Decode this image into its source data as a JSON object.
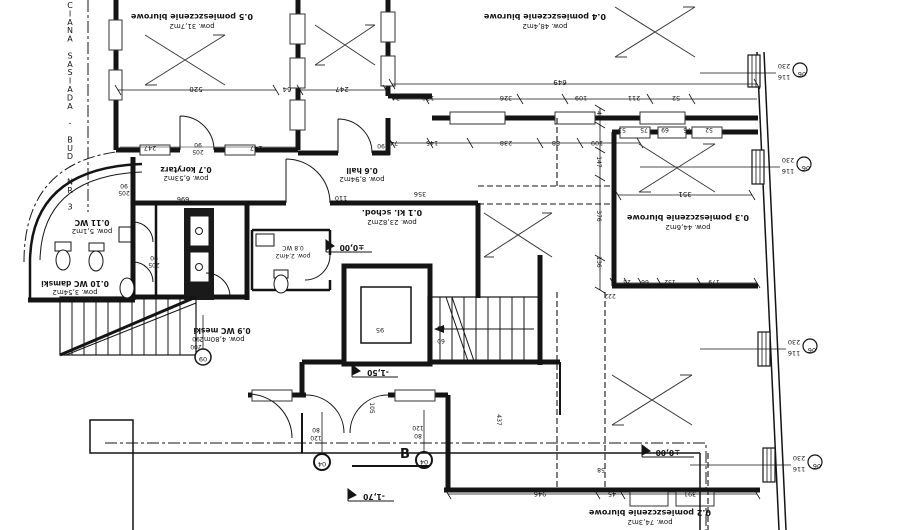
{
  "drawing": {
    "type": "architectural-floor-plan",
    "neighbor_wall_note": "CIANA SASIADA - BUD. NR 3",
    "section_label": "B",
    "line_color": "#141414",
    "background": "#ffffff"
  },
  "rooms": [
    {
      "id": "0.1",
      "name": "kl. schod.",
      "area": "pow. 23,82m2"
    },
    {
      "id": "0.2",
      "name": "pomieszczenie biurowe",
      "area": "pow. 74,3m2"
    },
    {
      "id": "0.3",
      "name": "pomieszczenie biurowe",
      "area": "pow. 44,6m2"
    },
    {
      "id": "0.4",
      "name": "pomieszczenie biurowe",
      "area": "pow. 48,4m2"
    },
    {
      "id": "0.5",
      "name": "pomieszczenie biurowe",
      "area": "pow. 31,7m2"
    },
    {
      "id": "0.6",
      "name": "hall",
      "area": "pow. 8,94m2"
    },
    {
      "id": "0.7",
      "name": "korytarz",
      "area": "pow. 6,53m2"
    },
    {
      "id": "0.8",
      "name": "WC",
      "area": "pow. 2,4m2"
    },
    {
      "id": "0.9",
      "name": "WC meski",
      "area": "pow. 4,80m2"
    },
    {
      "id": "0.10",
      "name": "WC damski",
      "area": "pow. 3,54m2"
    },
    {
      "id": "0.11",
      "name": "WC",
      "area": "pow. 5,1m2"
    }
  ],
  "window_type": {
    "tag": "06",
    "width": "116",
    "height": "230"
  },
  "levels": {
    "ground": "±0,00",
    "landing": "-1,50",
    "entry": "-1,70"
  },
  "side_text": "CIANA SASIADA - BUD. NR 3",
  "section_label": "B",
  "labels": [
    {
      "t": "0.5 pomieszczenie biurowe",
      "x": 192,
      "y": 14,
      "r": 180,
      "s": 8,
      "n": "room-05-name"
    },
    {
      "t": "pow. 31,7m2",
      "x": 192,
      "y": 24,
      "r": 180,
      "s": 7,
      "n": "room-05-area"
    },
    {
      "t": "0.4 pomieszczenie biurowe",
      "x": 545,
      "y": 14,
      "r": 180,
      "s": 8,
      "n": "room-04-name"
    },
    {
      "t": "pow. 48,4m2",
      "x": 545,
      "y": 24,
      "r": 180,
      "s": 7,
      "n": "room-04-area"
    },
    {
      "t": "0.3 pomieszczenie biurowe",
      "x": 688,
      "y": 215,
      "r": 180,
      "s": 8,
      "n": "room-03-name"
    },
    {
      "t": "pow. 44,6m2",
      "x": 688,
      "y": 225,
      "r": 180,
      "s": 7,
      "n": "room-03-area"
    },
    {
      "t": "0.2 pomieszczenie biurowe",
      "x": 650,
      "y": 510,
      "r": 180,
      "s": 8,
      "n": "room-02-name"
    },
    {
      "t": "pow. 74,3m2",
      "x": 650,
      "y": 520,
      "r": 180,
      "s": 7,
      "n": "room-02-area"
    },
    {
      "t": "0.1 kl. schod.",
      "x": 392,
      "y": 210,
      "r": 180,
      "s": 8,
      "n": "room-01-name"
    },
    {
      "t": "pow. 23,82m2",
      "x": 392,
      "y": 220,
      "r": 180,
      "s": 7,
      "n": "room-01-area"
    },
    {
      "t": "0.6 hall",
      "x": 362,
      "y": 168,
      "r": 180,
      "s": 75,
      "n": "room-06-name"
    },
    {
      "t": "pow. 8,94m2",
      "x": 362,
      "y": 177,
      "r": 180,
      "s": 7,
      "n": "room-06-area"
    },
    {
      "t": "0.7 korytarz",
      "x": 186,
      "y": 167,
      "r": 180,
      "s": 75,
      "n": "room-07-name"
    },
    {
      "t": "pow. 6,53m2",
      "x": 186,
      "y": 176,
      "r": 180,
      "s": 7,
      "n": "room-07-area"
    },
    {
      "t": "0.8 WC",
      "x": 293,
      "y": 246,
      "r": 180,
      "s": 6,
      "n": "room-08-name"
    },
    {
      "t": "pow. 2,4m2",
      "x": 293,
      "y": 254,
      "r": 180,
      "s": 6,
      "n": "room-08-area"
    },
    {
      "t": "0.9 WC meski",
      "x": 222,
      "y": 328,
      "r": 180,
      "s": 75,
      "n": "room-09-name"
    },
    {
      "t": "pow. 4,80m2",
      "x": 222,
      "y": 337,
      "r": 180,
      "s": 7,
      "n": "room-09-area"
    },
    {
      "t": "0.10 WC damski",
      "x": 75,
      "y": 281,
      "r": 180,
      "s": 75,
      "n": "room-010-name"
    },
    {
      "t": "pow. 3,54m2",
      "x": 75,
      "y": 290,
      "r": 180,
      "s": 7,
      "n": "room-010-area"
    },
    {
      "t": "0.11 WC",
      "x": 92,
      "y": 220,
      "r": 180,
      "s": 75,
      "n": "room-011-name"
    },
    {
      "t": "pow. 5,1m2",
      "x": 92,
      "y": 229,
      "r": 180,
      "s": 7,
      "n": "room-011-area"
    },
    {
      "t": "±0,00",
      "x": 352,
      "y": 245,
      "r": 180,
      "s": 75,
      "n": "level-zero"
    },
    {
      "t": "±0,00",
      "x": 668,
      "y": 450,
      "r": 180,
      "s": 75,
      "n": "level-zero"
    },
    {
      "t": "-1,50",
      "x": 378,
      "y": 370,
      "r": 180,
      "s": 75,
      "n": "level-minus150"
    },
    {
      "t": "-1,70",
      "x": 374,
      "y": 494,
      "r": 180,
      "s": 75,
      "n": "level-minus170"
    },
    {
      "t": "520",
      "x": 196,
      "y": 87,
      "r": 180,
      "s": 7,
      "n": "dim"
    },
    {
      "t": "64",
      "x": 287,
      "y": 87,
      "r": 180,
      "s": 7,
      "n": "dim"
    },
    {
      "t": "247",
      "x": 342,
      "y": 87,
      "r": 180,
      "s": 7,
      "n": "dim"
    },
    {
      "t": "649",
      "x": 560,
      "y": 80,
      "r": 180,
      "s": 7,
      "n": "dim"
    },
    {
      "t": "34",
      "x": 396,
      "y": 96,
      "r": 180,
      "s": 65,
      "n": "dim"
    },
    {
      "t": "130",
      "x": 428,
      "y": 96,
      "r": 180,
      "s": 65,
      "n": "dim"
    },
    {
      "t": "326",
      "x": 506,
      "y": 96,
      "r": 180,
      "s": 65,
      "n": "dim"
    },
    {
      "t": "109",
      "x": 581,
      "y": 96,
      "r": 180,
      "s": 65,
      "n": "dim"
    },
    {
      "t": "211",
      "x": 634,
      "y": 96,
      "r": 180,
      "s": 65,
      "n": "dim"
    },
    {
      "t": "52",
      "x": 676,
      "y": 96,
      "r": 180,
      "s": 65,
      "n": "dim"
    },
    {
      "t": "74",
      "x": 394,
      "y": 141,
      "r": 180,
      "s": 65,
      "n": "dim"
    },
    {
      "t": "145",
      "x": 432,
      "y": 141,
      "r": 180,
      "s": 65,
      "n": "dim"
    },
    {
      "t": "238",
      "x": 506,
      "y": 141,
      "r": 180,
      "s": 65,
      "n": "dim"
    },
    {
      "t": "88",
      "x": 556,
      "y": 141,
      "r": 180,
      "s": 65,
      "n": "dim"
    },
    {
      "t": "109",
      "x": 597,
      "y": 141,
      "r": 180,
      "s": 65,
      "n": "dim"
    },
    {
      "t": "247",
      "x": 150,
      "y": 146,
      "r": 180,
      "s": 65,
      "n": "dim"
    },
    {
      "t": "247",
      "x": 256,
      "y": 146,
      "r": 180,
      "s": 65,
      "n": "dim"
    },
    {
      "t": "90",
      "x": 198,
      "y": 143,
      "r": 180,
      "s": 6,
      "n": "door-size"
    },
    {
      "t": "205",
      "x": 198,
      "y": 150,
      "r": 180,
      "s": 6,
      "n": "door-size"
    },
    {
      "t": "90",
      "x": 381,
      "y": 144,
      "r": 180,
      "s": 6,
      "n": "door-size"
    },
    {
      "t": "205",
      "x": 381,
      "y": 151,
      "r": 180,
      "s": 6,
      "n": "door-size"
    },
    {
      "t": "90",
      "x": 124,
      "y": 184,
      "r": 180,
      "s": 6,
      "n": "door-size"
    },
    {
      "t": "205",
      "x": 124,
      "y": 191,
      "r": 180,
      "s": 6,
      "n": "door-size"
    },
    {
      "t": "90",
      "x": 154,
      "y": 256,
      "r": 180,
      "s": 6,
      "n": "door-size"
    },
    {
      "t": "205",
      "x": 154,
      "y": 263,
      "r": 180,
      "s": 6,
      "n": "door-size"
    },
    {
      "t": "696",
      "x": 183,
      "y": 197,
      "r": 180,
      "s": 65,
      "n": "dim"
    },
    {
      "t": "110",
      "x": 341,
      "y": 196,
      "r": 180,
      "s": 65,
      "n": "dim"
    },
    {
      "t": "356",
      "x": 420,
      "y": 192,
      "r": 180,
      "s": 65,
      "n": "dim"
    },
    {
      "t": "351",
      "x": 685,
      "y": 192,
      "r": 180,
      "s": 7,
      "n": "dim"
    },
    {
      "t": "53",
      "x": 622,
      "y": 128,
      "r": 180,
      "s": 6,
      "n": "dim"
    },
    {
      "t": "75",
      "x": 644,
      "y": 128,
      "r": 180,
      "s": 6,
      "n": "dim"
    },
    {
      "t": "69",
      "x": 665,
      "y": 128,
      "r": 180,
      "s": 6,
      "n": "dim"
    },
    {
      "t": "75",
      "x": 687,
      "y": 128,
      "r": 180,
      "s": 6,
      "n": "dim"
    },
    {
      "t": "52",
      "x": 709,
      "y": 128,
      "r": 180,
      "s": 6,
      "n": "dim"
    },
    {
      "t": "23",
      "x": 627,
      "y": 280,
      "r": 180,
      "s": 6,
      "n": "dim"
    },
    {
      "t": "66",
      "x": 645,
      "y": 280,
      "r": 180,
      "s": 6,
      "n": "dim"
    },
    {
      "t": "152",
      "x": 670,
      "y": 280,
      "r": 180,
      "s": 6,
      "n": "dim"
    },
    {
      "t": "179",
      "x": 714,
      "y": 280,
      "r": 180,
      "s": 6,
      "n": "dim"
    },
    {
      "t": "44",
      "x": 597,
      "y": 115,
      "r": 90,
      "s": 6,
      "n": "dim"
    },
    {
      "t": "147",
      "x": 597,
      "y": 162,
      "r": 90,
      "s": 6,
      "n": "dim"
    },
    {
      "t": "376",
      "x": 597,
      "y": 216,
      "r": 90,
      "s": 6,
      "n": "dim"
    },
    {
      "t": "136",
      "x": 597,
      "y": 262,
      "r": 90,
      "s": 6,
      "n": "dim"
    },
    {
      "t": "222",
      "x": 610,
      "y": 294,
      "r": 180,
      "s": 6,
      "n": "dim"
    },
    {
      "t": "95",
      "x": 380,
      "y": 328,
      "r": 180,
      "s": 65,
      "n": "dim"
    },
    {
      "t": "60",
      "x": 441,
      "y": 326,
      "r": 180,
      "s": 6,
      "n": "dim"
    },
    {
      "t": "60",
      "x": 441,
      "y": 339,
      "r": 180,
      "s": 6,
      "n": "dim"
    },
    {
      "t": "105",
      "x": 370,
      "y": 408,
      "r": 90,
      "s": 6,
      "n": "dim"
    },
    {
      "t": "437",
      "x": 497,
      "y": 420,
      "r": 90,
      "s": 6,
      "n": "dim"
    },
    {
      "t": "58",
      "x": 601,
      "y": 468,
      "r": 180,
      "s": 6,
      "n": "dim"
    },
    {
      "t": "946",
      "x": 540,
      "y": 492,
      "r": 180,
      "s": 65,
      "n": "dim"
    },
    {
      "t": "45",
      "x": 612,
      "y": 492,
      "r": 180,
      "s": 65,
      "n": "dim"
    },
    {
      "t": "391",
      "x": 690,
      "y": 492,
      "r": 180,
      "s": 65,
      "n": "dim"
    },
    {
      "t": "80",
      "x": 316,
      "y": 428,
      "r": 180,
      "s": 6,
      "n": "door-size"
    },
    {
      "t": "120",
      "x": 316,
      "y": 436,
      "r": 180,
      "s": 6,
      "n": "door-size"
    },
    {
      "t": "120",
      "x": 418,
      "y": 426,
      "r": 180,
      "s": 6,
      "n": "door-size"
    },
    {
      "t": "80",
      "x": 418,
      "y": 434,
      "r": 180,
      "s": 6,
      "n": "door-size"
    },
    {
      "t": "90",
      "x": 196,
      "y": 337,
      "r": 180,
      "s": 6,
      "n": "door-size"
    },
    {
      "t": "200",
      "x": 196,
      "y": 345,
      "r": 180,
      "s": 6,
      "n": "door-size"
    },
    {
      "t": "230",
      "x": 784,
      "y": 64,
      "r": 180,
      "s": 65,
      "n": "window-height"
    },
    {
      "t": "116",
      "x": 784,
      "y": 75,
      "r": 180,
      "s": 65,
      "n": "window-width"
    },
    {
      "t": "06",
      "x": 802,
      "y": 72,
      "r": 180,
      "s": 65,
      "n": "window-tag"
    },
    {
      "t": "230",
      "x": 788,
      "y": 158,
      "r": 180,
      "s": 65,
      "n": "window-height"
    },
    {
      "t": "116",
      "x": 788,
      "y": 169,
      "r": 180,
      "s": 65,
      "n": "window-width"
    },
    {
      "t": "06",
      "x": 806,
      "y": 166,
      "r": 180,
      "s": 65,
      "n": "window-tag"
    },
    {
      "t": "230",
      "x": 794,
      "y": 340,
      "r": 180,
      "s": 65,
      "n": "window-height"
    },
    {
      "t": "116",
      "x": 794,
      "y": 351,
      "r": 180,
      "s": 65,
      "n": "window-width"
    },
    {
      "t": "06",
      "x": 812,
      "y": 348,
      "r": 180,
      "s": 65,
      "n": "window-tag"
    },
    {
      "t": "230",
      "x": 799,
      "y": 456,
      "r": 180,
      "s": 65,
      "n": "window-height"
    },
    {
      "t": "116",
      "x": 799,
      "y": 467,
      "r": 180,
      "s": 65,
      "n": "window-width"
    },
    {
      "t": "06",
      "x": 817,
      "y": 464,
      "r": 180,
      "s": 65,
      "n": "window-tag"
    },
    {
      "t": "04",
      "x": 322,
      "y": 462,
      "r": 180,
      "s": 65,
      "n": "door-tag"
    },
    {
      "t": "04",
      "x": 424,
      "y": 460,
      "r": 180,
      "s": 65,
      "n": "door-tag"
    },
    {
      "t": "09",
      "x": 203,
      "y": 357,
      "r": 180,
      "s": 65,
      "n": "door-tag"
    }
  ]
}
